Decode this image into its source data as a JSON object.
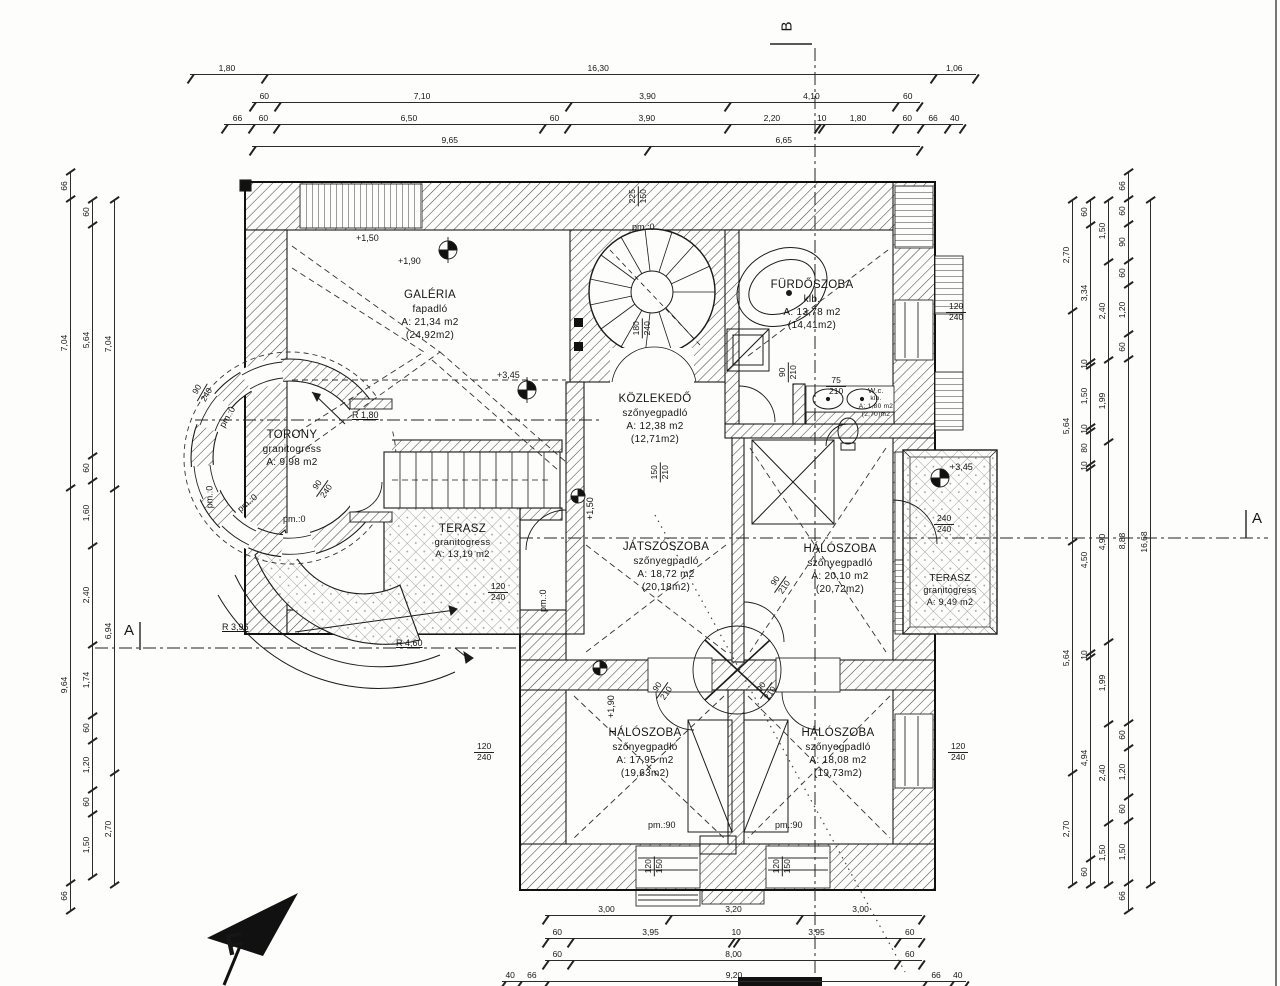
{
  "palette": {
    "ink": "#1b1b1b",
    "paper": "#fdfdfb",
    "hatch": "#444444",
    "terrace": "#777777"
  },
  "markers": {
    "section_b": "B",
    "section_a_left": "A",
    "section_a_right": "A",
    "north": "F"
  },
  "rooms": {
    "galeria": {
      "name": "GALÉRIA",
      "floor": "fapadló",
      "area": "A: 21,34 m2",
      "area_gross": "(24,92m2)"
    },
    "kozlekedo": {
      "name": "KÖZLEKEDŐ",
      "floor": "szőnyegpadló",
      "area": "A: 12,38 m2",
      "area_gross": "(12,71m2)"
    },
    "furdoszoba": {
      "name": "FÜRDŐSZOBA",
      "floor": "klb.",
      "area": "A: 13,78 m2",
      "area_gross": "(14,41m2)"
    },
    "wc": {
      "name": "W.c.",
      "floor": "klb.",
      "area": "A: 1,80 m2",
      "area_gross": "(2,70)m2"
    },
    "torony": {
      "name": "TORONY",
      "floor": "granitogress",
      "area": "A: 9,98 m2"
    },
    "terasz_left": {
      "name": "TERASZ",
      "floor": "granitogress",
      "area": "A: 13,19 m2"
    },
    "jatszoszoba": {
      "name": "JÁTSZÓSZOBA",
      "floor": "szőnyegpadló",
      "area": "A: 18,72 m2",
      "area_gross": "(20,18m2)"
    },
    "haloszoba_mid": {
      "name": "HÁLÓSZOBA",
      "floor": "szőnyegpadló",
      "area": "A: 20,10 m2",
      "area_gross": "(20,72m2)"
    },
    "terasz_right": {
      "name": "TERASZ",
      "floor": "granitogress",
      "area": "A: 9,49 m2"
    },
    "haloszoba_bl": {
      "name": "HÁLÓSZOBA",
      "floor": "szőnyegpadló",
      "area": "A: 17,95 m2",
      "area_gross": "(19,63m2)"
    },
    "haloszoba_br": {
      "name": "HÁLÓSZOBA",
      "floor": "szőnyegpadló",
      "area": "A: 18,08 m2",
      "area_gross": "(19,73m2)"
    }
  },
  "dims": {
    "top": [
      [
        "1,80",
        "16,30",
        "1,06"
      ],
      [
        "60",
        "7,10",
        "3,90",
        "4,10",
        "60"
      ],
      [
        "66",
        "60",
        "6,50",
        "60",
        "3,90",
        "2,20",
        "10",
        "1,80",
        "60",
        "66",
        "40"
      ],
      [
        "9,65",
        "6,65"
      ]
    ],
    "bottom": [
      [
        "3,00",
        "3,20",
        "3,00"
      ],
      [
        "60",
        "3,95",
        "10",
        "3,95",
        "60"
      ],
      [
        "60",
        "8,00",
        "60"
      ],
      [
        "40",
        "66",
        "9,20",
        "66",
        "40"
      ]
    ],
    "left": [
      [
        "66",
        "7,04",
        "9,64",
        "66"
      ],
      [
        "60",
        "5,64",
        "60",
        "1,60",
        "2,40",
        "1,74",
        "60",
        "1,20",
        "60",
        "1,50"
      ],
      [
        "7,04",
        "6,94",
        "2,70"
      ]
    ],
    "right": [
      [
        "2,70",
        "5,64",
        "5,64",
        "2,70"
      ],
      [
        "60",
        "3,34",
        "10",
        "1,50",
        "10",
        "80",
        "10",
        "4,50",
        "10",
        "4,94",
        "60"
      ],
      [
        "1,50",
        "2,40",
        "1,99",
        "4,90",
        "1,99",
        "2,40",
        "1,50"
      ],
      [
        "66",
        "60",
        "90",
        "60",
        "1,20",
        "60",
        "8,88",
        "60",
        "1,20",
        "60",
        "1,50",
        "66"
      ],
      [
        "16,68"
      ]
    ]
  },
  "levels": {
    "galeria_150": "+1,50",
    "galeria_190": "+1,90",
    "galeria_345": "+3,45",
    "terasz_150": "+1,50",
    "bottom_190": "+1,90",
    "terasz_right_345": "+3,45"
  },
  "radii": {
    "tower": "R 1,80",
    "stair_inner": "R 3,96",
    "stair_outer": "R 4,60"
  },
  "plinth": {
    "pm0": "pm.:0",
    "pm90": "pm.:90"
  },
  "openings": {
    "win_bath": {
      "w": "120",
      "h": "240"
    },
    "door_wc": {
      "w": "75",
      "h": "210"
    },
    "door_bath": {
      "w": "90",
      "h": "210"
    },
    "win_terasz": {
      "w": "120",
      "h": "240"
    },
    "win_bedroom_left": {
      "w": "120",
      "h": "240"
    },
    "win_bedroom_right": {
      "w": "120",
      "h": "240"
    },
    "door_terasz_right": {
      "w": "240",
      "h": "240"
    },
    "win_center": {
      "w": "150",
      "h": "210"
    },
    "door_stair": {
      "w": "180",
      "h": "240"
    },
    "door_tower": {
      "w": "90",
      "h": "240"
    },
    "door_room": {
      "w": "90",
      "h": "210"
    },
    "win_stair_top": {
      "w": "225",
      "h": "150"
    },
    "win_bottom": {
      "w": "120",
      "h": "150"
    }
  }
}
